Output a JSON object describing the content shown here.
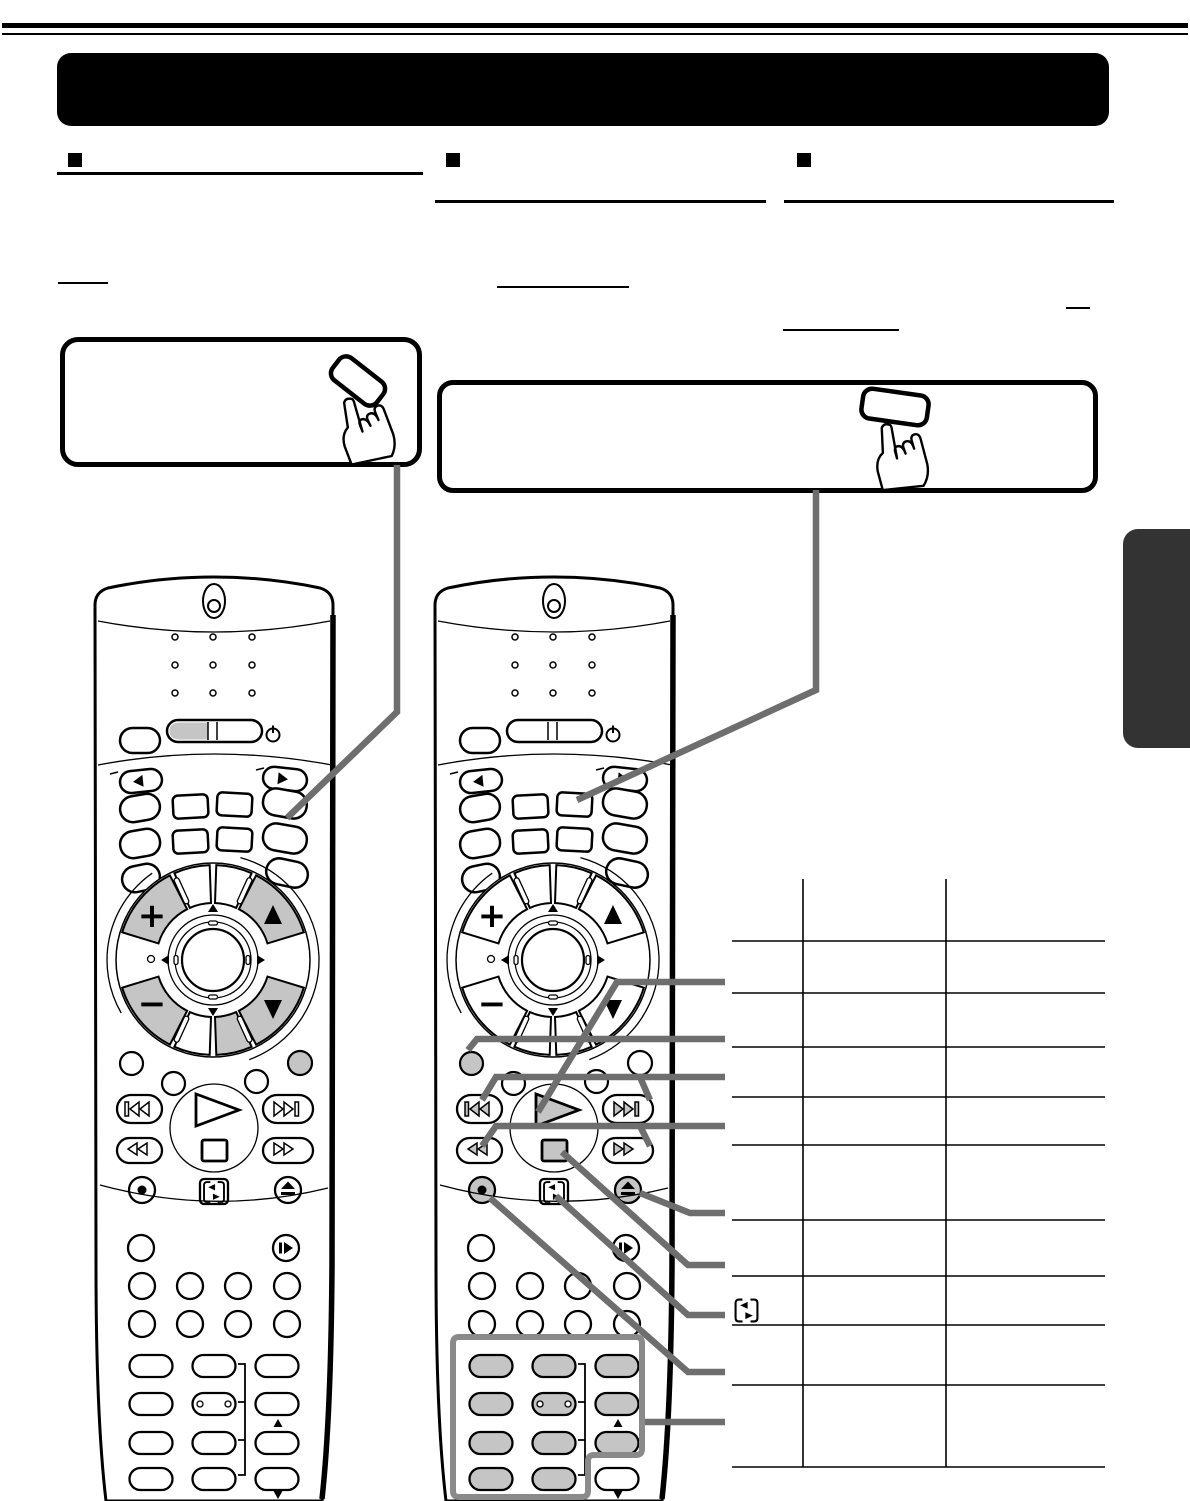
{
  "page": {
    "kind": "scanned-remote-control-manual-page",
    "background": "#ffffff",
    "visible_text": "",
    "note": "all text areas of the scan are blank; only line art, rules and underlines are rendered"
  },
  "header": {
    "top_rule_style": "double",
    "banner_text": ""
  },
  "sections": [
    {
      "bullet": "square",
      "title_text": "",
      "underline": true
    },
    {
      "bullet": "square",
      "title_text": "",
      "underline": true
    },
    {
      "bullet": "square",
      "title_text": "",
      "underline": true
    }
  ],
  "reference_underline_count": 4,
  "callouts": {
    "box1": {
      "text": "",
      "illustration": "finger-pressing-button"
    },
    "box2": {
      "text": "",
      "illustration": "finger-pressing-button"
    }
  },
  "glyphs": {
    "plus": "+",
    "minus": "−"
  },
  "colors": {
    "ink": "#000000",
    "button_shade": "#c5c5c5",
    "leader_line": "#6e6e6e",
    "highlight_box": "#8a8a8a",
    "side_tab": "#333333"
  },
  "icons": [
    "power-icon",
    "led-window-icon",
    "left-triangle-icon",
    "right-triangle-icon",
    "plus-icon",
    "minus-icon",
    "up-triangle-icon",
    "down-triangle-icon",
    "nav-ring-icon",
    "skip-back-icon",
    "skip-forward-icon",
    "rewind-icon",
    "fast-forward-icon",
    "play-icon",
    "stop-icon",
    "record-icon",
    "eject-icon",
    "sound-swap-icon",
    "frame-advance-icon",
    "hand-press-icon"
  ],
  "remotes": [
    {
      "id": "remote-a",
      "shaded_controls": "mode key half, plus/minus, channel up/down, lower-right wedge, right dot"
    },
    {
      "id": "remote-b",
      "shaded_controls": "transport keys, record, eject, left dot, number pad"
    }
  ],
  "table": {
    "columns": 3,
    "data_rows": 9,
    "cells_text": "",
    "leader_lines_into_rows": 9
  }
}
